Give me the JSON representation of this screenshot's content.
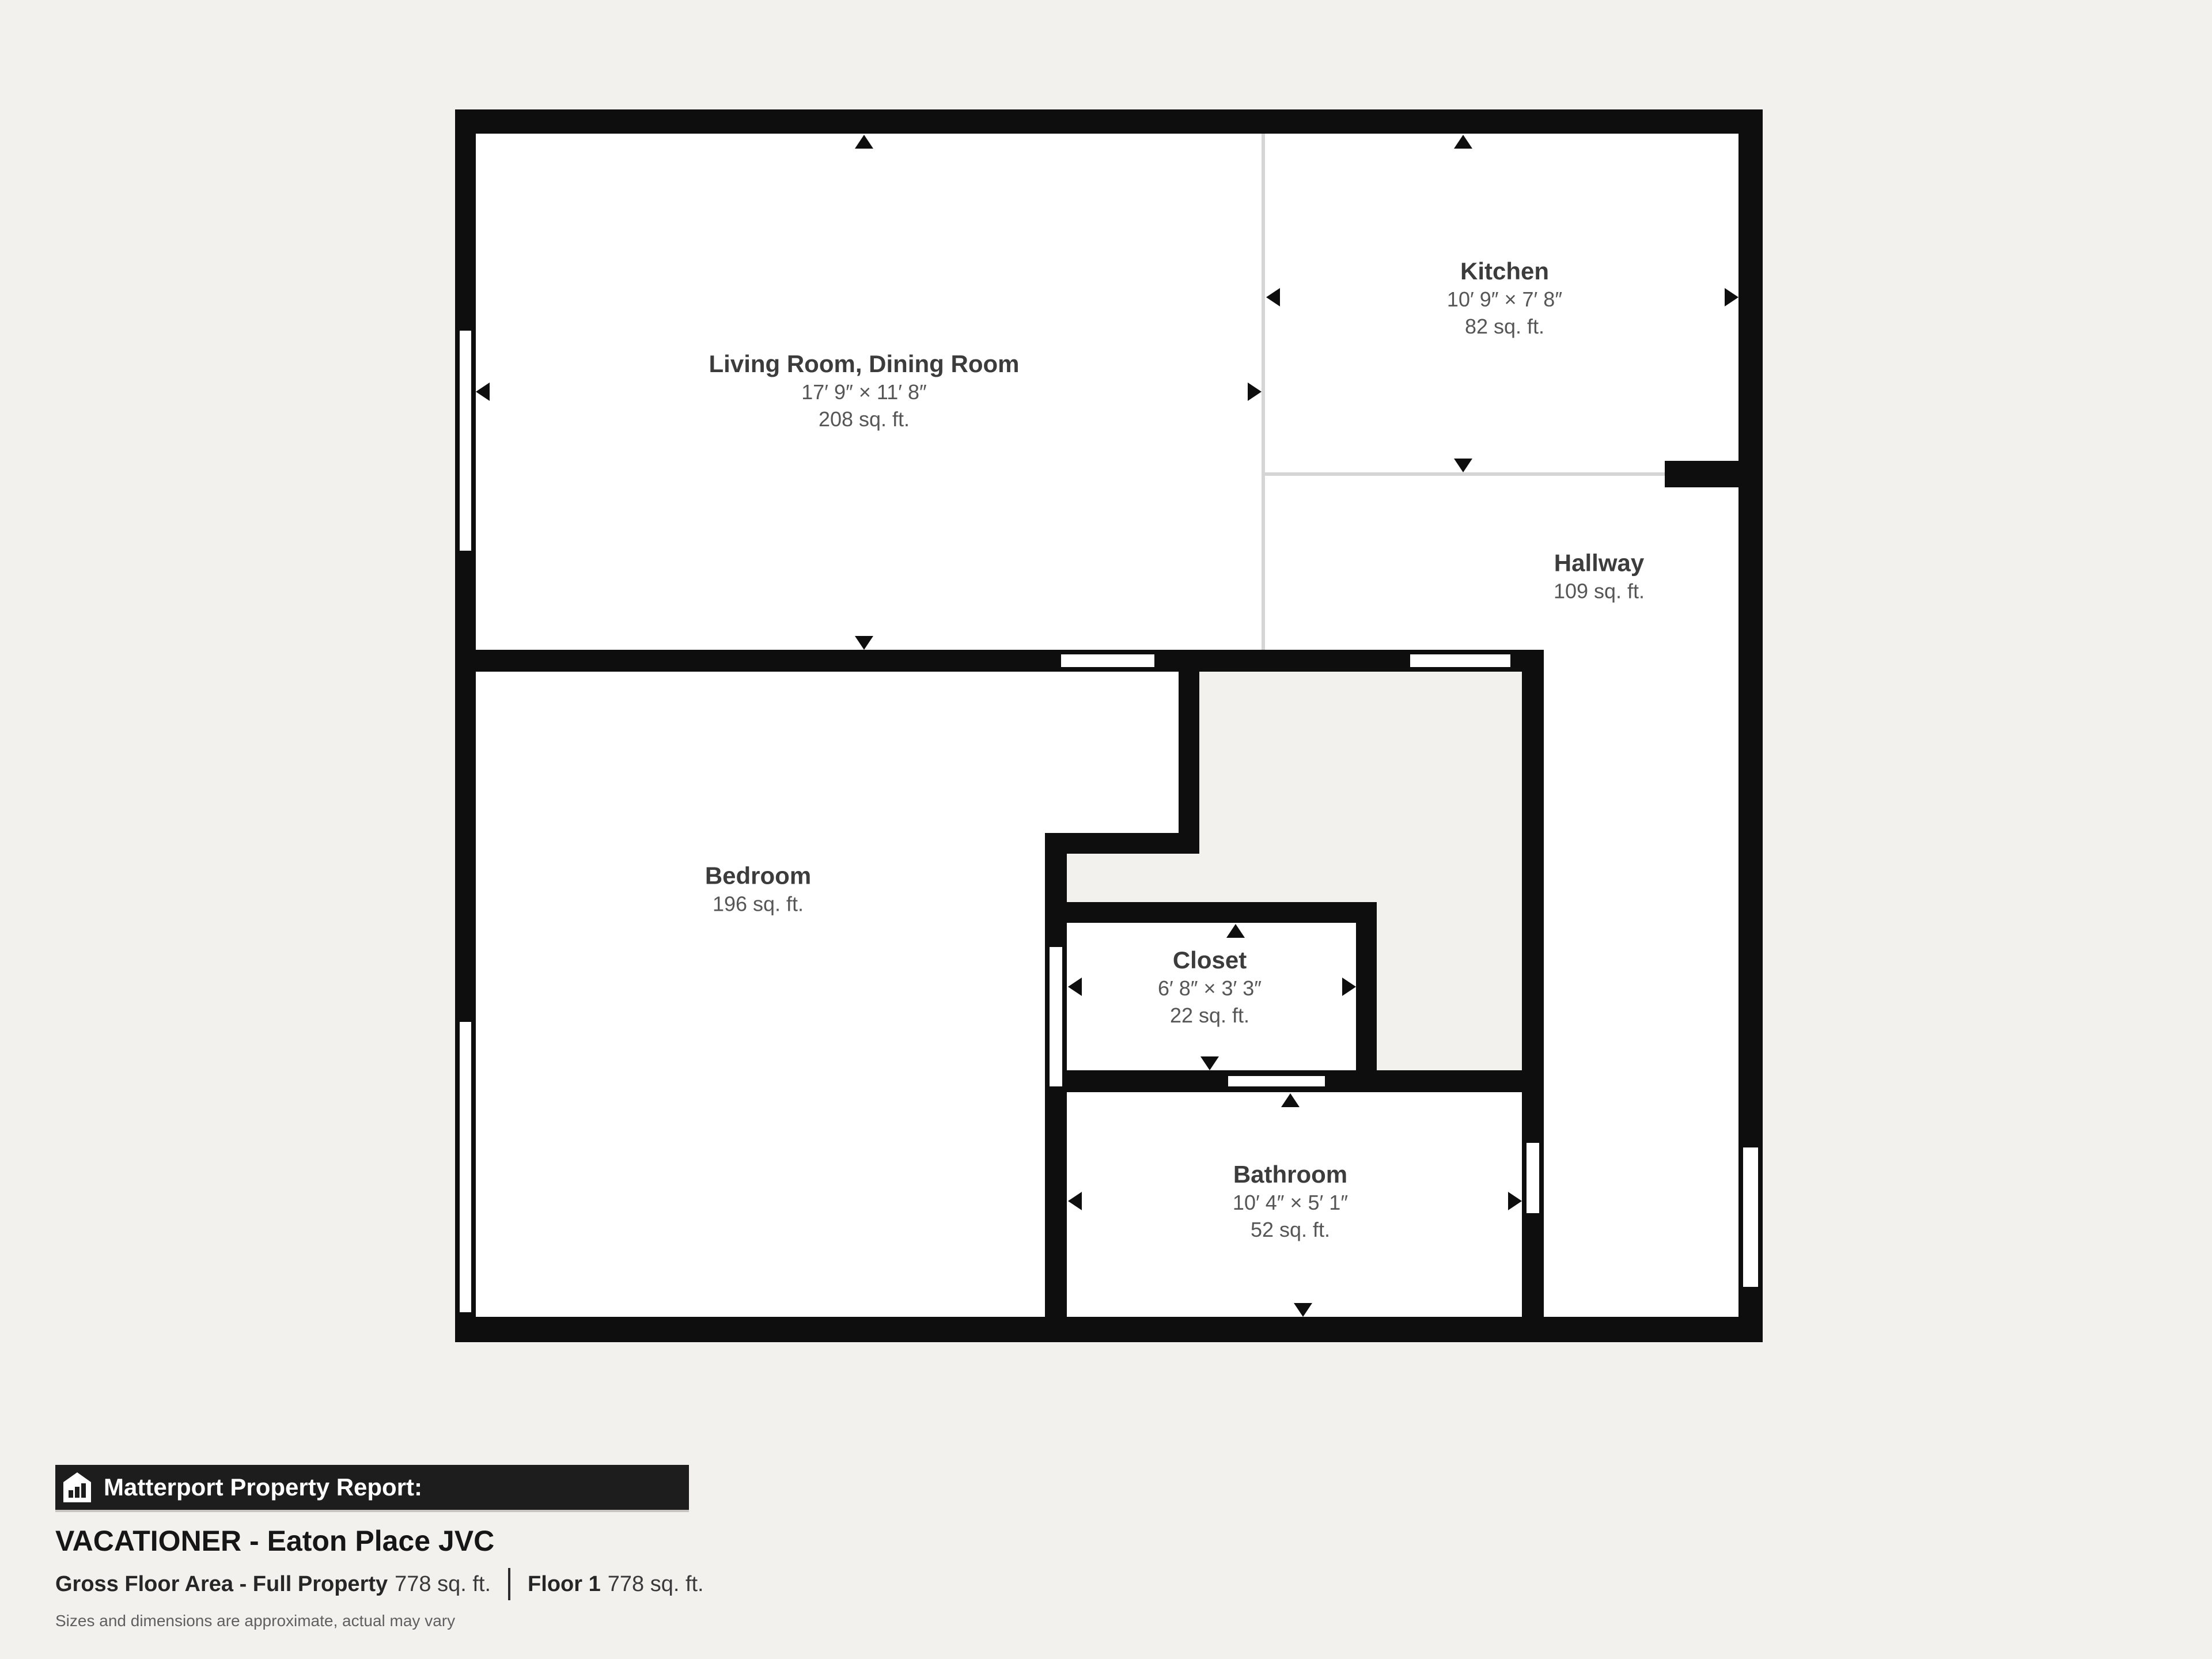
{
  "plan": {
    "rooms": [
      {
        "id": "living",
        "name": "Living Room, Dining Room",
        "dims": "17′ 9″ × 11′ 8″",
        "area": "208 sq. ft."
      },
      {
        "id": "kitchen",
        "name": "Kitchen",
        "dims": "10′ 9″ × 7′ 8″",
        "area": "82 sq. ft."
      },
      {
        "id": "hallway",
        "name": "Hallway",
        "dims": "",
        "area": "109 sq. ft."
      },
      {
        "id": "bedroom",
        "name": "Bedroom",
        "dims": "",
        "area": "196 sq. ft."
      },
      {
        "id": "closet",
        "name": "Closet",
        "dims": "6′ 8″ × 3′ 3″",
        "area": "22 sq. ft."
      },
      {
        "id": "bathroom",
        "name": "Bathroom",
        "dims": "10′ 4″ × 5′ 1″",
        "area": "52 sq. ft."
      }
    ]
  },
  "footer": {
    "icon": "house-chart-icon",
    "report_label": "Matterport Property Report:",
    "property_name": "VACATIONER - Eaton Place JVC",
    "gross_label": "Gross Floor Area - Full Property",
    "gross_value": "778 sq. ft.",
    "floor_label": "Floor 1",
    "floor_value": "778 sq. ft.",
    "disclaimer": "Sizes and dimensions are approximate, actual may vary"
  },
  "colors": {
    "background": "#f2f1ee",
    "wall": "#0e0e0e",
    "room_fill": "#ffffff",
    "open_boundary": "#d5d5d5",
    "label_title": "#3c3c3c",
    "label_sub": "#565656",
    "footer_bar": "#1d1d1d"
  }
}
